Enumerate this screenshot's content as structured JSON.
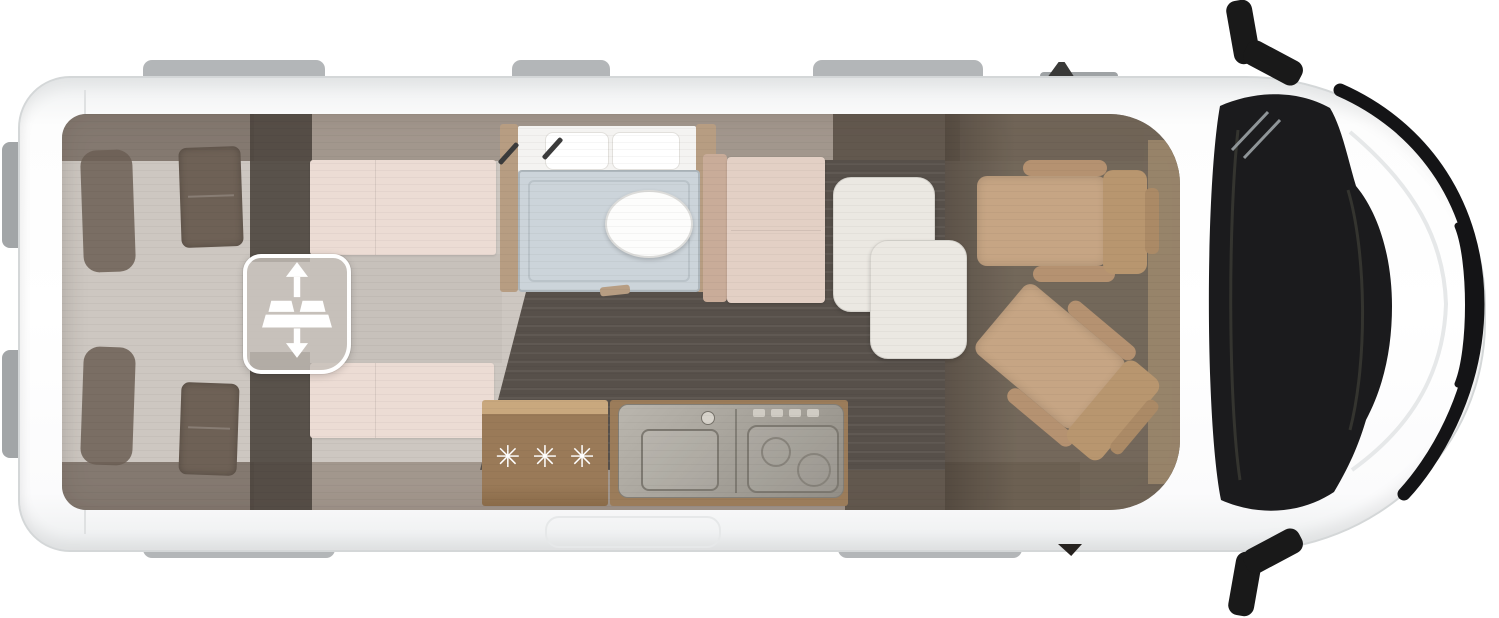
{
  "scene": {
    "description": "Top-down floor plan of a white camper van; rear doors left, driver cab right",
    "fridge_label": "✳✳✳"
  },
  "icons": {
    "bed_lift_icon": "drop-down bed with up/down arrows",
    "bed_lift_up_arrow": "↑",
    "bed_lift_down_arrow": "↓",
    "frost_asterisk": "✳"
  },
  "colors": {
    "page_bg": "#ffffff",
    "body_outline": "#d4d7d8",
    "roof_tab": "#b3b6b8",
    "interior_base": "#cdc7c1",
    "overhead_band": "#8d7d6e",
    "wardrobe_dark": "#4d453e",
    "mattress_pink": "#ecdcd4",
    "pillow_taupe": "#6e6156",
    "floor_dark": "#57504a",
    "cab_floor": "#6d6153",
    "bathroom_wall_tan": "#b79d82",
    "shower_tray": "#ccd4da",
    "kitchen_wood": "#9a7a58",
    "counter_metal": "#a8a49c",
    "table_white": "#ebe8e2",
    "seat_tan": "#c6a584",
    "windshield_black": "#1b1b1d"
  }
}
